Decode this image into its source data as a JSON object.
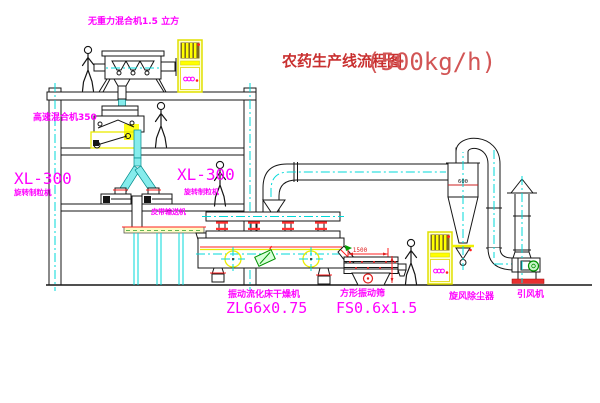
{
  "title": {
    "text": "农药生产线流程图",
    "capacity": "(500kg/h)"
  },
  "equipment": {
    "gravity_mixer": {
      "label": "无重力混合机1.5 立方"
    },
    "high_speed_mixer": {
      "label": "高速混合机350"
    },
    "granulator_left": {
      "model": "XL-300",
      "name": "旋转制粒机"
    },
    "granulator_right": {
      "model": "XL-300",
      "name": "旋转制粒机"
    },
    "belt_conveyor": {
      "label": "皮带输送机"
    },
    "fluid_bed_dryer": {
      "label": "振动流化床干燥机",
      "model": "ZLG6x0.75"
    },
    "square_sieve": {
      "label": "方形振动筛",
      "model": "FS0.6x1.5"
    },
    "cyclone": {
      "label": "旋风除尘器",
      "dim": "600"
    },
    "induced_fan": {
      "label": "引风机"
    }
  },
  "dimensions": {
    "sieve_width": "1500"
  },
  "colors": {
    "label_magenta": "#ff00ff",
    "title_red": "#c93030",
    "dimension_red": "#e02020",
    "centerline_cyan": "#00d8d8",
    "cabinet_yellow": "#ecec00",
    "motor_green": "#009000"
  }
}
